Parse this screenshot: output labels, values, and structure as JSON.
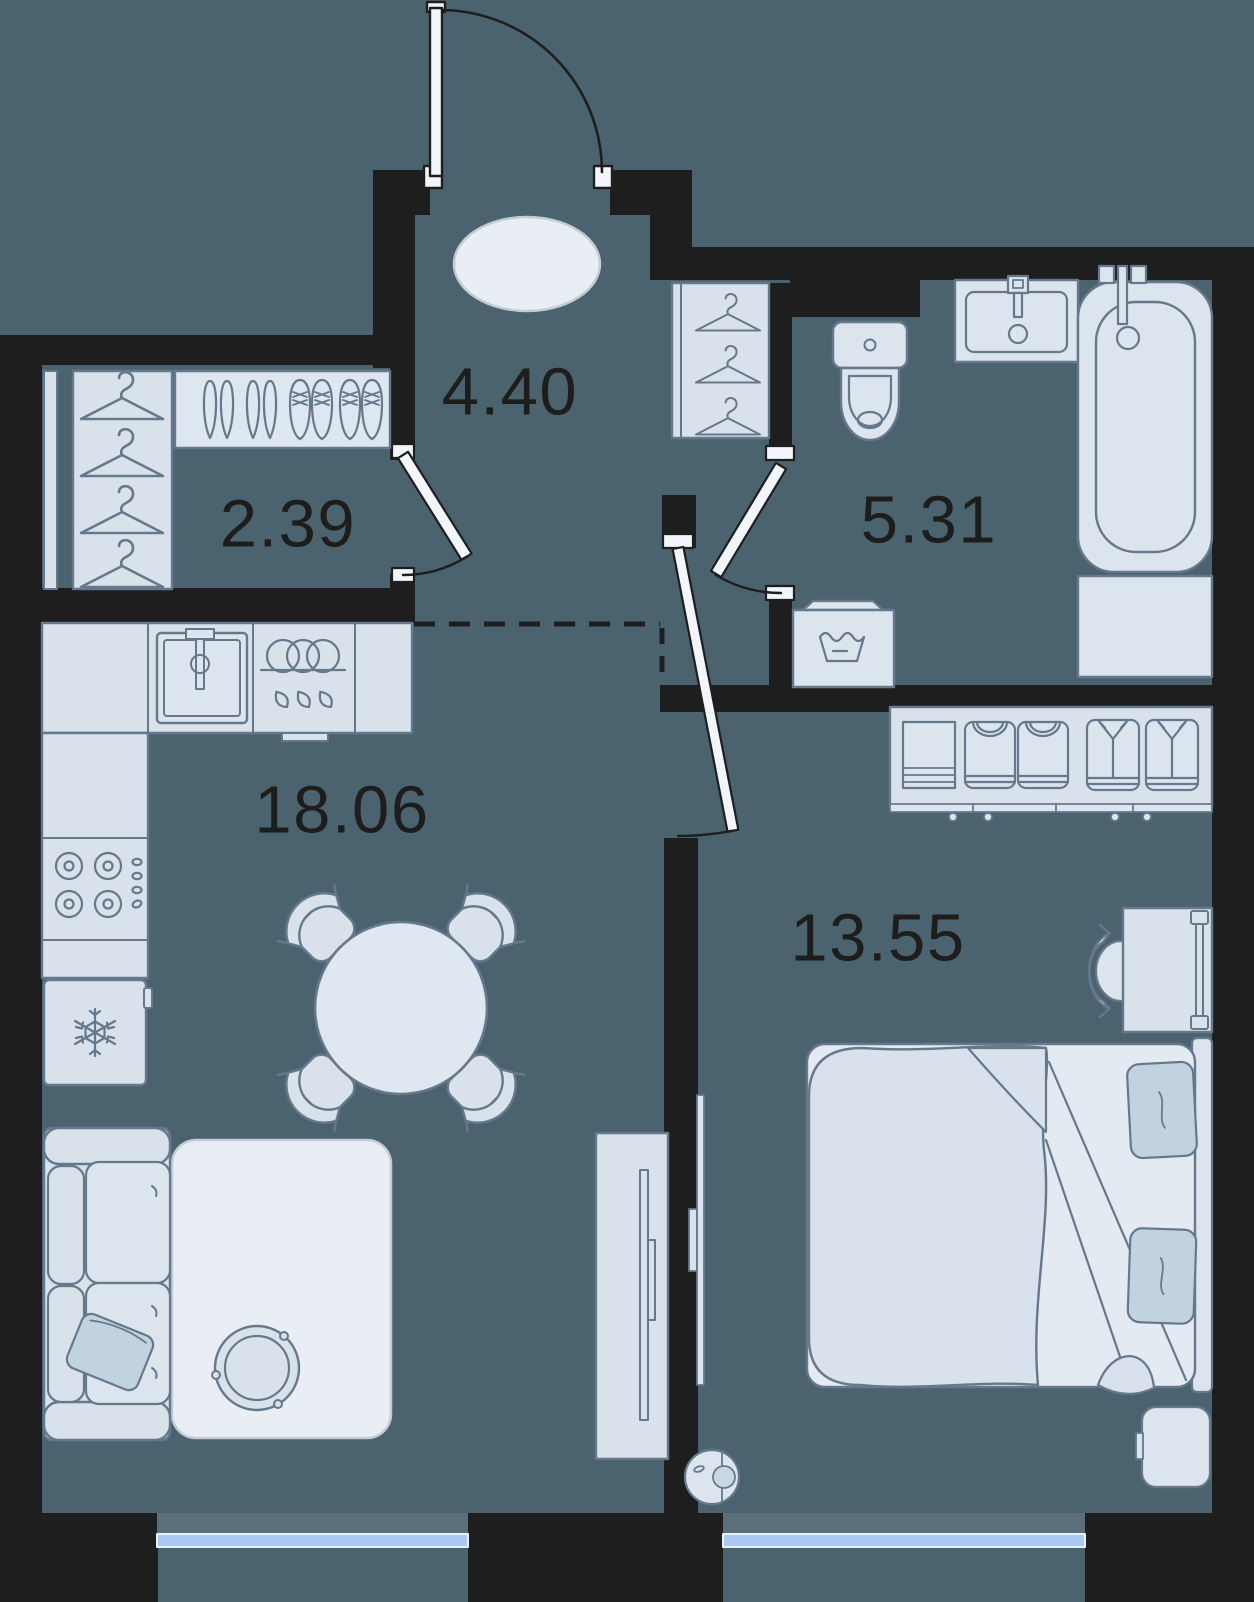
{
  "title": "Apartment floor plan",
  "rooms": [
    {
      "id": "hallway",
      "area": "4.40"
    },
    {
      "id": "wardrobe",
      "area": "2.39"
    },
    {
      "id": "bathroom",
      "area": "5.31"
    },
    {
      "id": "kitchen-living-room",
      "area": "18.06"
    },
    {
      "id": "bedroom",
      "area": "13.55"
    }
  ],
  "colors": {
    "floor": "#4b636e",
    "wall": "#1e1e1e",
    "furniture_fill": "#d9e2eb",
    "furniture_bright": "#e9eef5",
    "furniture_stroke": "#66788c",
    "pillow": "#c2d3e0",
    "window_glass": "#abcaf1",
    "window_sill": "#5a6f7a",
    "door_leaf": "#f2f5f9",
    "label_text": "#1d1d1b"
  },
  "icons": [
    "entry-door",
    "interior-door",
    "hanger",
    "shoes",
    "toilet",
    "bathroom-sink",
    "bathtub",
    "washing-machine",
    "kitchen-sink",
    "dish-dryer",
    "stove",
    "fridge-snowflake",
    "dining-table",
    "dining-chair",
    "sofa",
    "pillow",
    "rug",
    "coffee-table",
    "tv",
    "tv-console",
    "wardrobe-shelf",
    "folded-clothes",
    "shirt",
    "clothes-rail",
    "desk",
    "desk-chair",
    "bed",
    "nightstand",
    "robot-vacuum",
    "window"
  ]
}
